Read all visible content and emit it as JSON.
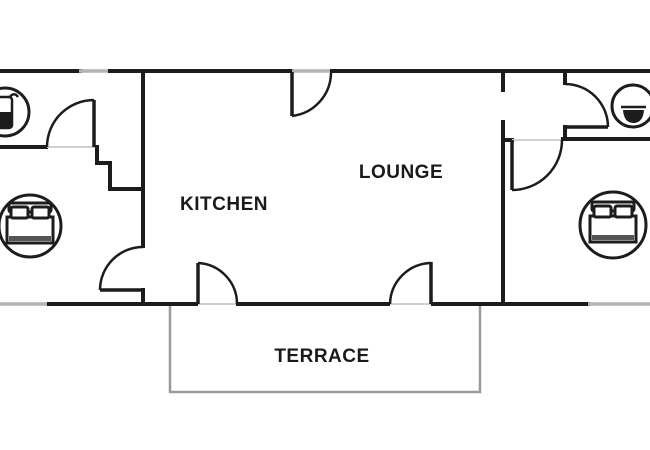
{
  "rooms": {
    "kitchen": {
      "label": "KITCHEN"
    },
    "lounge": {
      "label": "LOUNGE"
    },
    "terrace": {
      "label": "TERRACE"
    }
  },
  "icons": {
    "left_bathroom": "shower-icon",
    "right_bathroom": "washbasin-icon",
    "left_bedroom": "double-bed-icon",
    "right_bedroom": "double-bed-icon"
  },
  "colors": {
    "wall": "#1c1c1c",
    "window": "#b3b3b3",
    "threshold": "#cfcfcf",
    "terrace": "#9a9a9a",
    "text": "#1a1a1a",
    "bg": "#ffffff",
    "band": "#555555"
  }
}
